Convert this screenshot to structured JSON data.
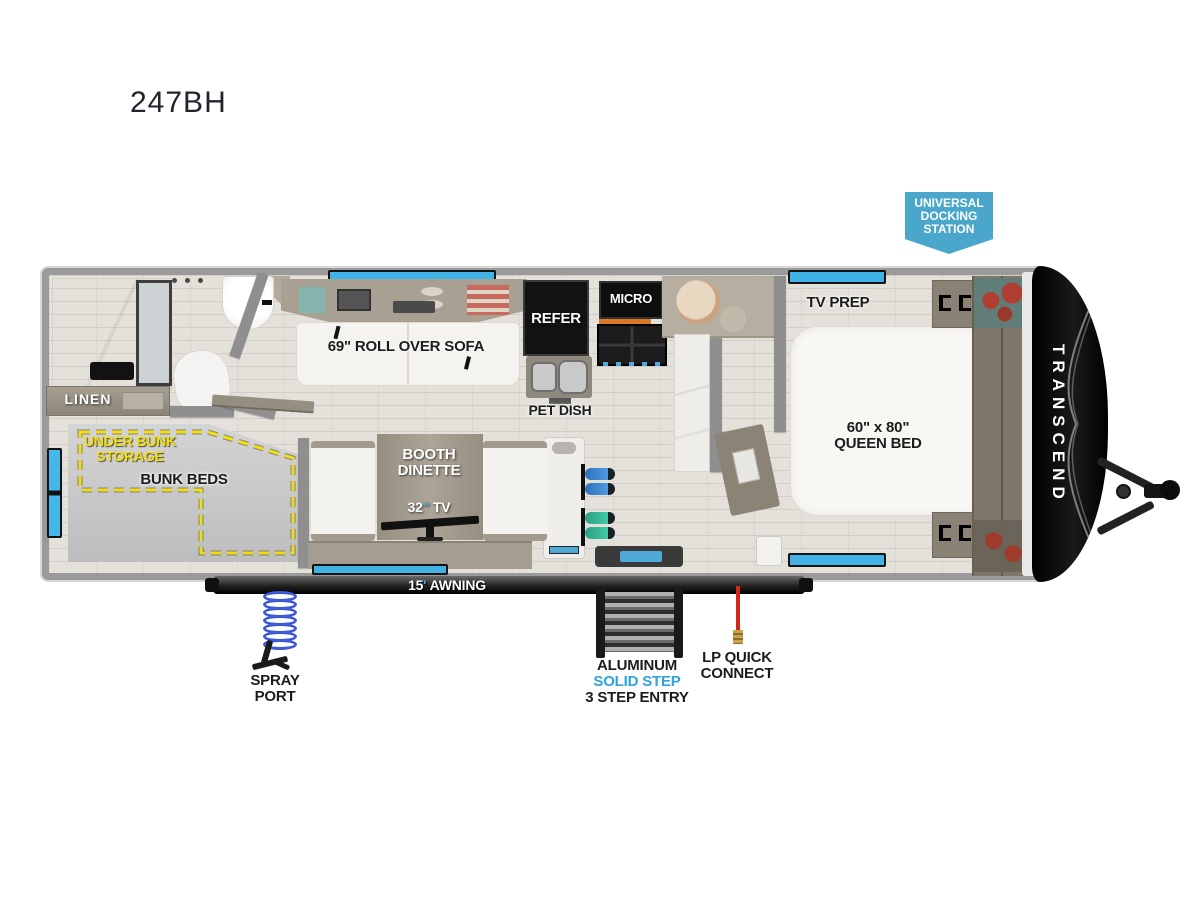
{
  "title": "247BH",
  "badge": {
    "line1": "UNIVERSAL",
    "line2": "DOCKING",
    "line3": "STATION"
  },
  "labels": {
    "linen": "LINEN",
    "sofa": "69\" ROLL OVER SOFA",
    "refer": "REFER",
    "micro": "MICRO",
    "pet_dish": "PET DISH",
    "tv_prep": "TV PREP",
    "bed_size": "60\" x 80\"",
    "bed_name": "QUEEN BED",
    "under_bunk_1": "UNDER BUNK",
    "under_bunk_2": "STORAGE",
    "bunk_beds": "BUNK BEDS",
    "booth_1": "BOOTH",
    "booth_2": "DINETTE",
    "tv_num": "32",
    "tv_mark": "\"",
    "tv_word": " TV",
    "brand": "TRANSCEND"
  },
  "exterior": {
    "awning_num": "15",
    "awning_mark": "'",
    "awning_word": " AWNING",
    "spray_1": "SPRAY",
    "spray_2": "PORT",
    "step_1": "ALUMINUM",
    "step_2": "SOLID STEP",
    "step_3": "3 STEP ENTRY",
    "lp_1": "LP QUICK",
    "lp_2": "CONNECT"
  },
  "colors": {
    "badge_blue": "#4AA7CB",
    "accent_blue": "#3FA9DC",
    "window_blue": "#41B2E6",
    "storage_yellow": "#F2DE12"
  }
}
